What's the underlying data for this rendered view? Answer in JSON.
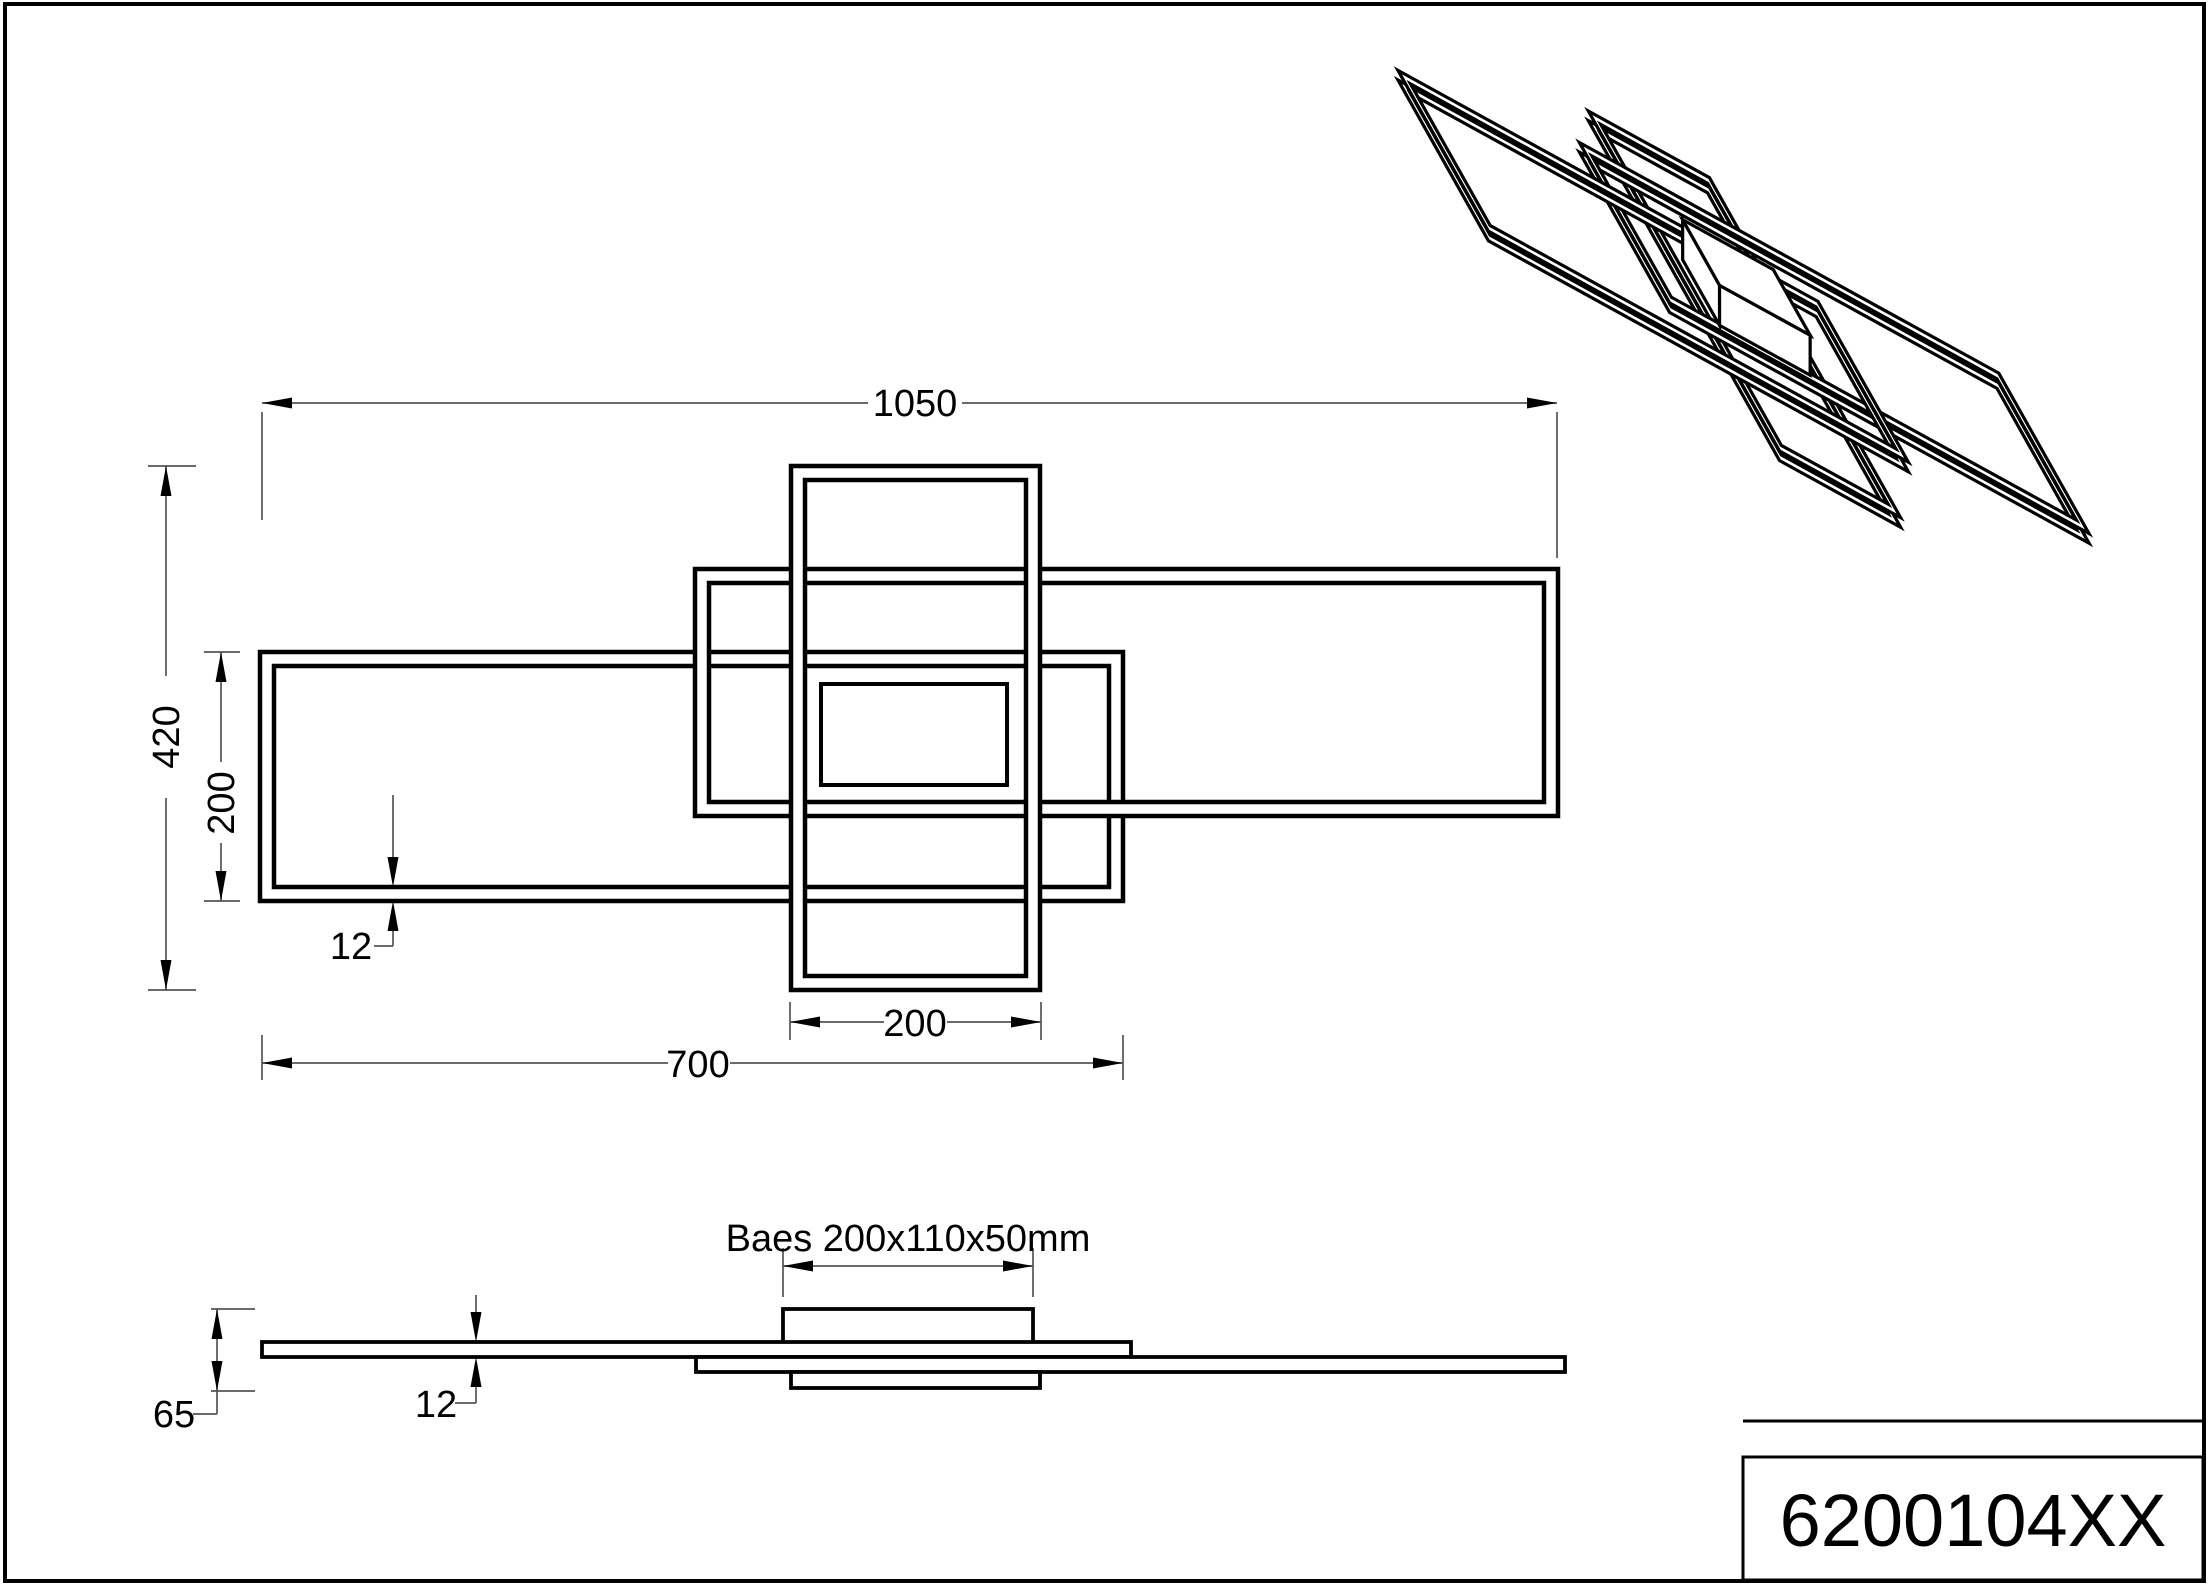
{
  "sheet": {
    "width": 2209,
    "height": 1586,
    "line_color": "#000000",
    "dim_color": "#555555",
    "background": "#ffffff"
  },
  "title_block": {
    "part_number": "6200104XX"
  },
  "plan_view": {
    "frames": [
      {
        "name": "frame-left-700x200",
        "outer": [
          260,
          652,
          1123,
          901
        ],
        "inset": 14
      },
      {
        "name": "frame-right-700x200",
        "outer": [
          695,
          569,
          1558,
          816
        ],
        "inset": 14
      },
      {
        "name": "frame-center-200x420",
        "outer": [
          791,
          466,
          1040,
          990
        ],
        "inset": 14
      }
    ],
    "base_rect": [
      821,
      684,
      186,
      101
    ],
    "dims": [
      {
        "id": "overall-width",
        "label": "1050",
        "segments": [
          [
            262,
            403,
            868,
            403
          ],
          [
            962,
            403,
            1557,
            403
          ]
        ],
        "exts": [
          [
            262,
            412,
            262,
            520
          ],
          [
            1557,
            412,
            1557,
            558
          ]
        ],
        "arrows": [
          [
            262,
            403,
            "left"
          ],
          [
            1557,
            403,
            "right"
          ]
        ]
      },
      {
        "id": "overall-depth",
        "label": "420",
        "segments": [
          [
            166,
            466,
            166,
            676
          ],
          [
            166,
            798,
            166,
            990
          ]
        ],
        "exts": [
          [
            148,
            466,
            196,
            466
          ],
          [
            148,
            990,
            196,
            990
          ]
        ],
        "arrows": [
          [
            166,
            466,
            "up"
          ],
          [
            166,
            990,
            "down"
          ]
        ]
      },
      {
        "id": "frame-depth",
        "label": "200",
        "segments": [
          [
            221,
            652,
            221,
            762
          ],
          [
            221,
            843,
            221,
            901
          ]
        ],
        "exts": [
          [
            204,
            652,
            240,
            652
          ],
          [
            204,
            901,
            240,
            901
          ]
        ],
        "arrows": [
          [
            221,
            652,
            "up"
          ],
          [
            221,
            901,
            "down"
          ]
        ]
      },
      {
        "id": "center-frame-width",
        "label": "200",
        "segments": [
          [
            790,
            1022,
            884,
            1022
          ],
          [
            947,
            1022,
            1041,
            1022
          ]
        ],
        "exts": [
          [
            790,
            1002,
            790,
            1040
          ],
          [
            1041,
            1002,
            1041,
            1040
          ]
        ],
        "arrows": [
          [
            790,
            1022,
            "left"
          ],
          [
            1041,
            1022,
            "right"
          ]
        ]
      },
      {
        "id": "frame-width",
        "label": "700",
        "segments": [
          [
            262,
            1063,
            668,
            1063
          ],
          [
            730,
            1063,
            1123,
            1063
          ]
        ],
        "exts": [
          [
            262,
            1035,
            262,
            1080
          ],
          [
            1123,
            1035,
            1123,
            1080
          ]
        ],
        "arrows": [
          [
            262,
            1063,
            "left"
          ],
          [
            1123,
            1063,
            "right"
          ]
        ]
      },
      {
        "id": "profile-width",
        "label": "12",
        "segments": [
          [
            393,
            795,
            393,
            857
          ],
          [
            393,
            931,
            393,
            946
          ],
          [
            374,
            946,
            393,
            946
          ]
        ],
        "exts": [],
        "arrows": [
          [
            393,
            887,
            "down"
          ],
          [
            393,
            901,
            "up"
          ]
        ]
      }
    ]
  },
  "side_view": {
    "base_label": "Baes 200x110x50mm",
    "shapes": [
      {
        "name": "base-top-profile",
        "rect": [
          783,
          1309,
          250,
          34
        ]
      },
      {
        "name": "left-frame-side-profile",
        "rect": [
          262,
          1342,
          869,
          15
        ]
      },
      {
        "name": "right-frame-side-profile",
        "rect": [
          696,
          1357,
          869,
          15
        ]
      },
      {
        "name": "center-frame-side-profile",
        "rect": [
          791,
          1372,
          249,
          16
        ]
      }
    ],
    "dims": [
      {
        "id": "overall-height",
        "label": "65",
        "segments": [
          [
            217,
            1309,
            217,
            1414
          ],
          [
            193,
            1414,
            217,
            1414
          ]
        ],
        "exts": [
          [
            211,
            1309,
            255,
            1309
          ],
          [
            211,
            1391,
            255,
            1391
          ]
        ],
        "arrows": [
          [
            217,
            1309,
            "up"
          ],
          [
            217,
            1391,
            "down"
          ]
        ]
      },
      {
        "id": "profile-height",
        "label": "12",
        "segments": [
          [
            476,
            1295,
            476,
            1312
          ],
          [
            476,
            1387,
            476,
            1403
          ],
          [
            455,
            1403,
            476,
            1403
          ]
        ],
        "exts": [],
        "arrows": [
          [
            476,
            1342,
            "down"
          ],
          [
            476,
            1357,
            "up"
          ]
        ]
      },
      {
        "id": "base-width",
        "label": "",
        "segments": [
          [
            783,
            1266,
            1033,
            1266
          ]
        ],
        "exts": [
          [
            783,
            1248,
            783,
            1297
          ],
          [
            1033,
            1248,
            1033,
            1297
          ]
        ],
        "arrows": [
          [
            783,
            1266,
            "left"
          ],
          [
            1033,
            1266,
            "right"
          ]
        ]
      }
    ]
  },
  "iso_view": {
    "projection": {
      "u": [
        0.6,
        0.33
      ],
      "v": [
        0.45,
        0.8
      ],
      "e": 0.8,
      "t": [
        1330,
        -20
      ],
      "inset_mm": 12,
      "thickness_mm": 12
    },
    "frames": [
      {
        "name": "iso-center-frame",
        "x0": 430.5,
        "y0": 0,
        "x1": 632.3,
        "y1": 425,
        "z": 13.8
      },
      {
        "name": "iso-right-frame",
        "x0": 353,
        "y0": 83.5,
        "x1": 1052,
        "y1": 284,
        "z": 26
      },
      {
        "name": "iso-left-frame",
        "x0": 0,
        "y0": 151,
        "x1": 700,
        "y1": 352,
        "z": 38
      }
    ],
    "base_box": {
      "name": "iso-base-box",
      "x0": 455,
      "y0": 177,
      "x1": 606,
      "y1": 259,
      "z_top": 65,
      "depth": 50
    }
  }
}
